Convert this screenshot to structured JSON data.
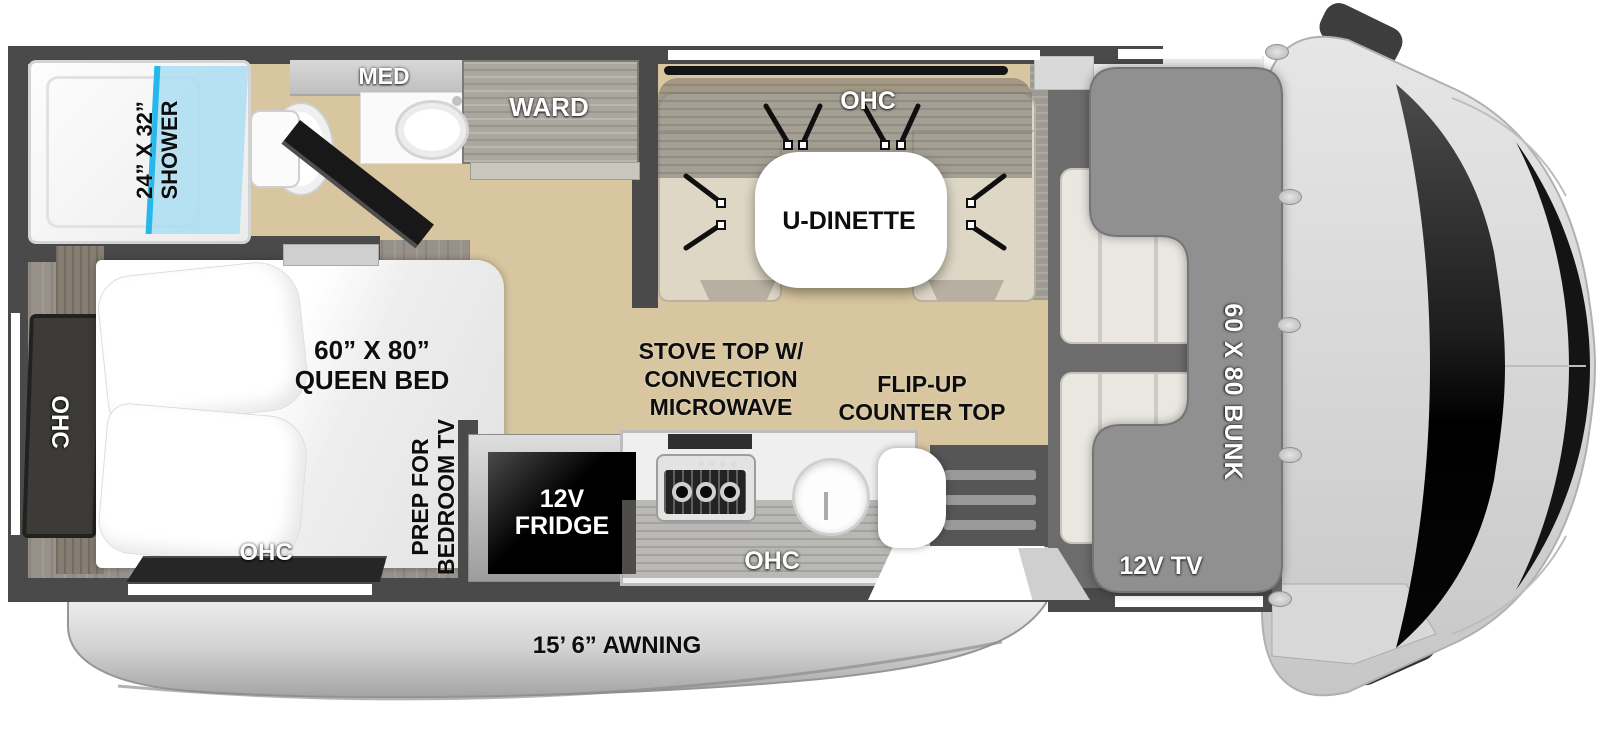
{
  "title": "Class C motorhome floorplan",
  "colors": {
    "wall": "#4a4a4a",
    "floor_wood": "#d8c6a0",
    "shower_glass": "#a7ddf2",
    "shower_glass_edge": "#27b7ea",
    "bunk_gray": "#909090",
    "bench_beige": "#ded7c6",
    "awning_gray": "#d3d3d3",
    "fridge_black": "#0a0a0a"
  },
  "bathroom": {
    "shower_size": "24” X 32”",
    "shower_name": "SHOWER",
    "med_cabinet": "MED",
    "wardrobe": "WARD"
  },
  "dinette": {
    "overhead_cabinet": "OHC",
    "table": "U-DINETTE"
  },
  "cab": {
    "bunk": "60 X 80 BUNK",
    "tv": "12V TV"
  },
  "bedroom": {
    "bed_size": "60” X 80”",
    "bed_name": "QUEEN BED",
    "overhead_cabinet_left": "OHC",
    "overhead_cabinet_bottom": "OHC",
    "tv_prep": [
      "PREP FOR",
      "BEDROOM TV"
    ]
  },
  "kitchen": {
    "stove": [
      "STOVE TOP W/",
      "CONVECTION",
      "MICROWAVE"
    ],
    "flip_counter": [
      "FLIP-UP",
      "COUNTER TOP"
    ],
    "fridge": [
      "12V",
      "FRIDGE"
    ],
    "overhead_cabinet": "OHC"
  },
  "exterior": {
    "awning": "15’ 6” AWNING"
  }
}
